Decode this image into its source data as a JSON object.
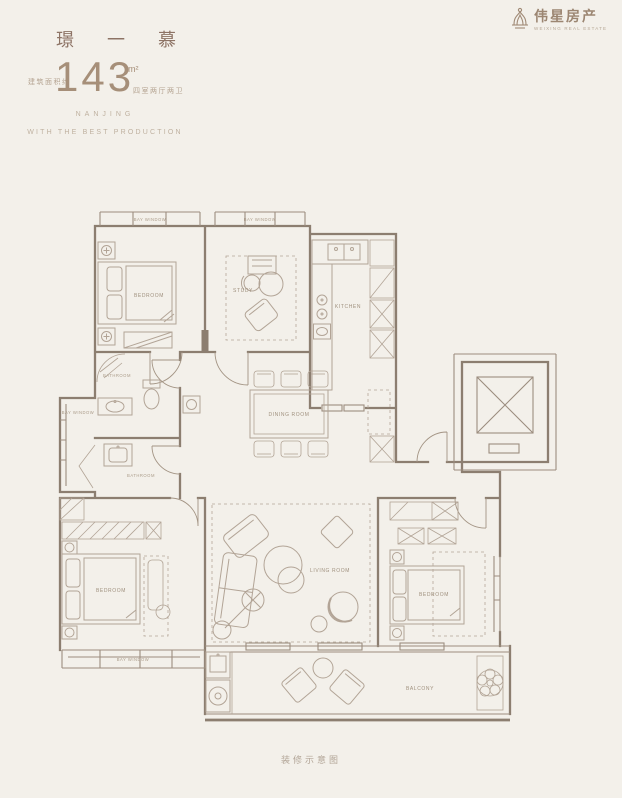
{
  "page": {
    "background": "#f3f0ea"
  },
  "colors": {
    "accent": "#8d7365",
    "line": "#8c7e70",
    "label": "#a0917f"
  },
  "header": {
    "title": "璟 一 慕",
    "area_prefix": "建筑面积约",
    "area_value": "143",
    "area_unit": "m²",
    "area_suffix": "四室两厅两卫",
    "tagline_line1": "NANJING",
    "tagline_line2": "WITH THE BEST PRODUCTION"
  },
  "brand": {
    "name": "伟星房产",
    "subtitle": "WEIXING REAL ESTATE"
  },
  "floorplan": {
    "labels": {
      "bay_window_1": "BAY WINDOW",
      "bay_window_2": "BAY WINDOW",
      "bay_window_3": "BAY WINDOW",
      "bay_window_4": "BAY WINDOW",
      "bedroom_1": "BEDROOM",
      "study": "STUDY",
      "kitchen": "KITCHEN",
      "bathroom_1": "BATHROOM",
      "bathroom_2": "BATHROOM",
      "dining_room": "DINING ROOM",
      "living_room": "LIVING ROOM",
      "bedroom_2": "BEDROOM",
      "bedroom_3": "BEDROOM",
      "balcony": "BALCONY"
    }
  },
  "footer": {
    "caption": "装修示意图"
  }
}
